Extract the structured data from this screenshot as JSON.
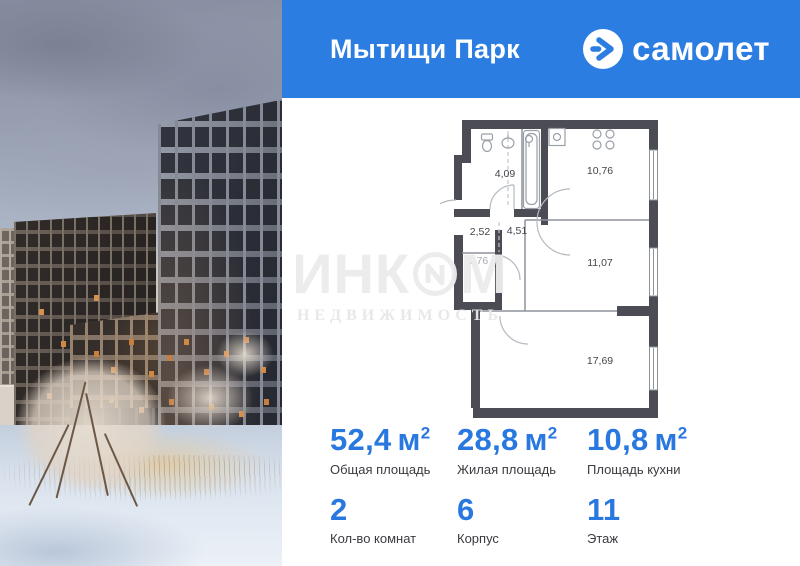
{
  "header": {
    "project_name": "Мытищи Парк",
    "brand_name": "самолет"
  },
  "watermark": {
    "word_part1": "ИНК",
    "word_part2": "М",
    "line2": "НЕДВИЖИМОСТЬ"
  },
  "floor_plan": {
    "rooms": [
      {
        "name": "bathroom",
        "area": "4,09"
      },
      {
        "name": "kitchen",
        "area": "10,76"
      },
      {
        "name": "hallway",
        "area": "2,52"
      },
      {
        "name": "corridor",
        "area": "4,51"
      },
      {
        "name": "storage",
        "area": "1,76"
      },
      {
        "name": "bedroom",
        "area": "11,07"
      },
      {
        "name": "living-room",
        "area": "17,69"
      }
    ]
  },
  "stats": {
    "cells": [
      {
        "value": "52,4",
        "unit": "м",
        "sup": "2",
        "label": "Общая площадь"
      },
      {
        "value": "28,8",
        "unit": "м",
        "sup": "2",
        "label": "Жилая площадь"
      },
      {
        "value": "10,8",
        "unit": "м",
        "sup": "2",
        "label": "Площадь кухни"
      },
      {
        "value": "2",
        "unit": "",
        "sup": "",
        "label": "Кол-во комнат"
      },
      {
        "value": "6",
        "unit": "",
        "sup": "",
        "label": "Корпус"
      },
      {
        "value": "11",
        "unit": "",
        "sup": "",
        "label": "Этаж"
      }
    ]
  },
  "colors": {
    "brand_blue": "#2b7de2",
    "accent_blue": "#2878df",
    "wall_gray": "#4b4c54"
  }
}
